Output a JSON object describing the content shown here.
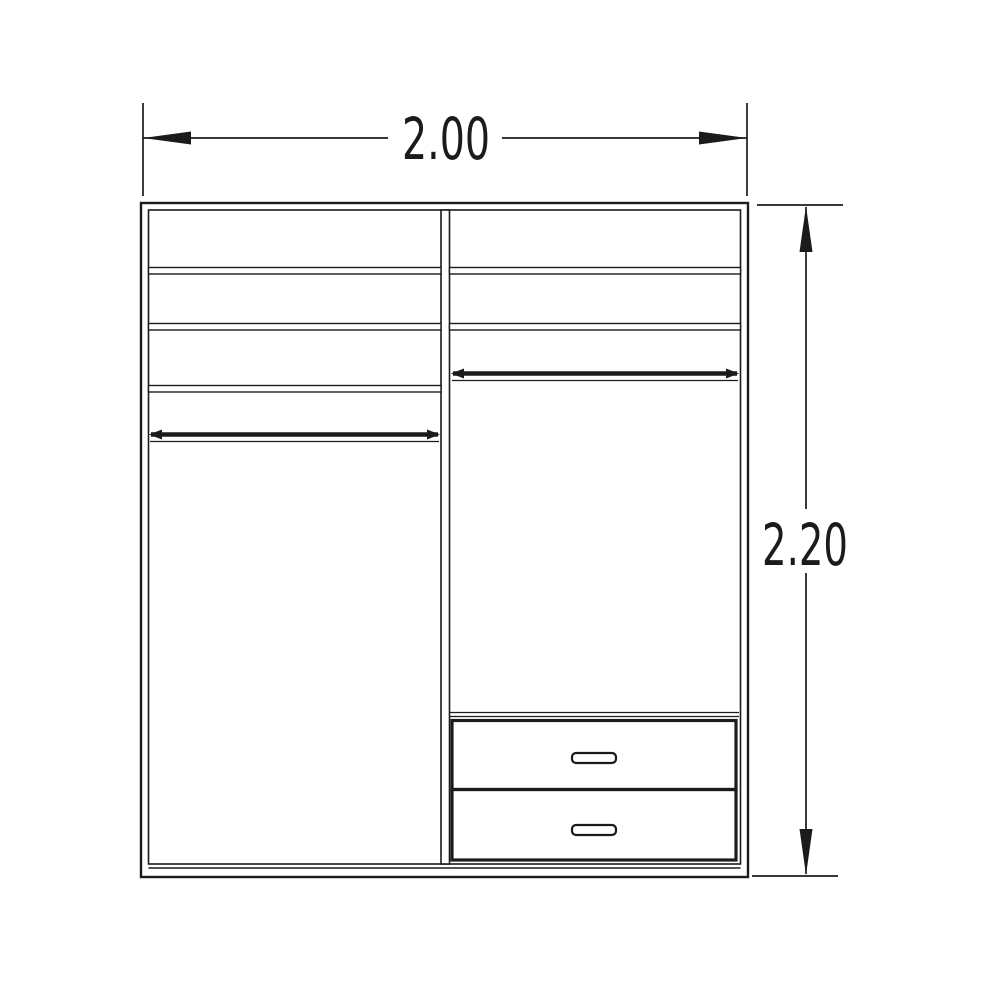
{
  "diagram": {
    "type": "technical-dimension-drawing",
    "subject": "wardrobe front elevation",
    "background_color": "#ffffff",
    "line_color": "#1b1b1b",
    "dimensions": {
      "width": {
        "value": "2.00",
        "orientation": "horizontal",
        "position": "top"
      },
      "height": {
        "value": "2.20",
        "orientation": "vertical",
        "position": "right"
      }
    },
    "components": {
      "left_compartment": {
        "shelf_count": 3,
        "hanging_rail_count": 1
      },
      "right_compartment": {
        "shelf_count": 2,
        "hanging_rail_count": 1,
        "drawer_count": 2,
        "drawer_handle_count": 2
      }
    }
  }
}
